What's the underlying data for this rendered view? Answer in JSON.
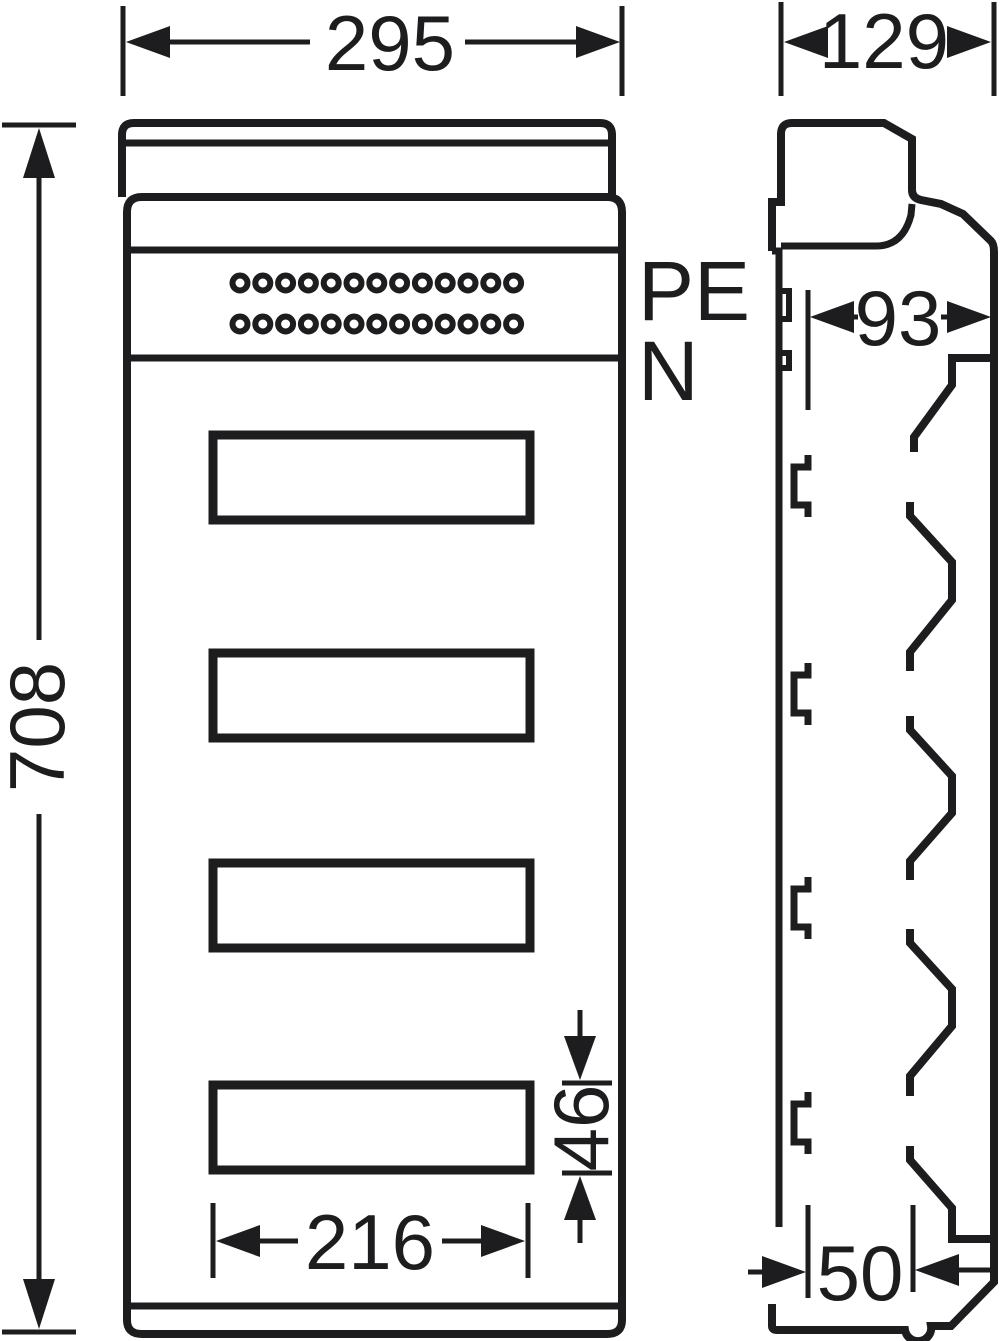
{
  "drawing": {
    "type": "technical-dimension-drawing",
    "front_view": {
      "width_mm": "295",
      "height_mm": "708",
      "window_width_mm": "216",
      "window_height_mm": "46",
      "pe_label": "PE",
      "n_label": "N",
      "window_count": 4,
      "terminal_rows": 2,
      "terminals_per_row": 13,
      "terminal_row_y": [
        283,
        324
      ],
      "terminal_start_x": 240,
      "terminal_spacing_x": 22.8
    },
    "side_view": {
      "depth_mm": "129",
      "front_depth_mm": "93",
      "base_depth_mm": "50"
    },
    "colors": {
      "line": "#1d1d1f",
      "background": "#ffffff"
    }
  }
}
